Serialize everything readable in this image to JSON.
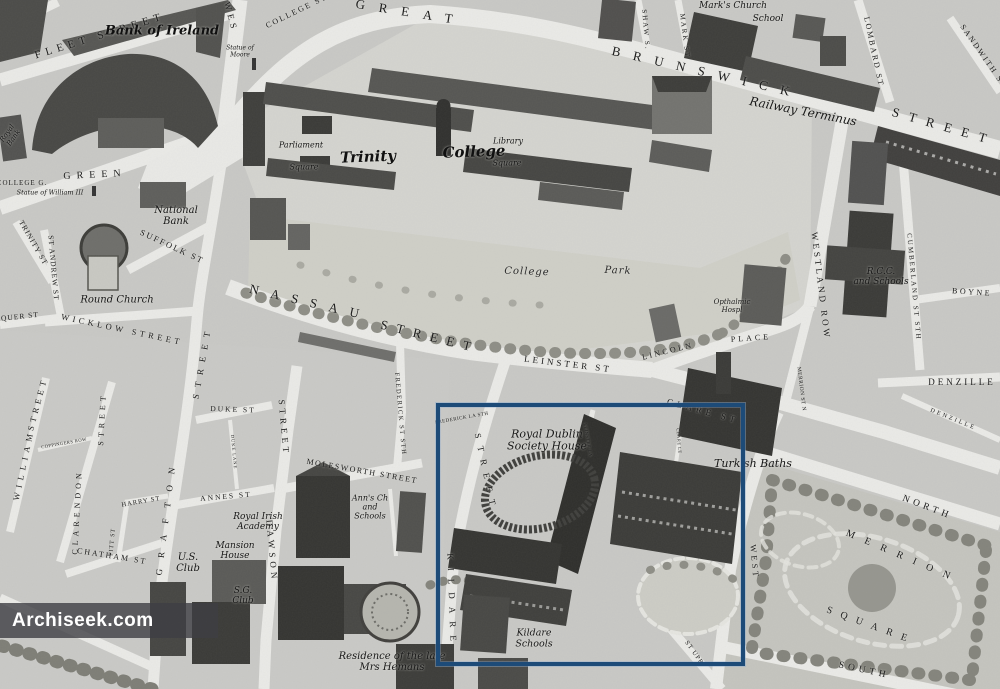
{
  "watermark": {
    "text": "Archiseek.com"
  },
  "highlight": {
    "color": "#1d4b78"
  },
  "map": {
    "labels": [
      {
        "n": "fleet-street",
        "t": "FLEET STREET",
        "x": 100,
        "y": 36,
        "r": -17,
        "fs": 11,
        "ls": 5,
        "st": "c"
      },
      {
        "n": "westmoreland-st",
        "t": "WES",
        "x": 231,
        "y": 17,
        "r": 75,
        "fs": 9,
        "ls": 4,
        "st": "c"
      },
      {
        "n": "college-st",
        "t": "COLLEGE ST",
        "x": 297,
        "y": 12,
        "r": -26,
        "fs": 8,
        "ls": 2,
        "st": "c"
      },
      {
        "n": "great",
        "t": "GREAT",
        "x": 411,
        "y": 13,
        "r": 9,
        "fs": 13,
        "ls": 14,
        "st": "c"
      },
      {
        "n": "brunswick",
        "t": "BRUNSWICK",
        "x": 707,
        "y": 73,
        "r": 13,
        "fs": 13,
        "ls": 13,
        "st": "c"
      },
      {
        "n": "gt-brunswick-street",
        "t": "STREET",
        "x": 944,
        "y": 127,
        "r": 16,
        "fs": 13,
        "ls": 10,
        "st": "c"
      },
      {
        "n": "railway-terminus",
        "t": "Railway Terminus",
        "x": 803,
        "y": 112,
        "r": 11,
        "fs": 12,
        "ls": 0,
        "st": "s"
      },
      {
        "n": "shaw-st",
        "t": "SHAW S.",
        "x": 645,
        "y": 30,
        "r": 85,
        "fs": 7,
        "ls": 2,
        "st": "c"
      },
      {
        "n": "mark-st",
        "t": "MARK ST",
        "x": 684,
        "y": 36,
        "r": 83,
        "fs": 7,
        "ls": 2,
        "st": "c"
      },
      {
        "n": "marks-church",
        "t": "Mark's Church",
        "x": 733,
        "y": 6,
        "r": 0,
        "fs": 9,
        "ls": 0,
        "st": "s"
      },
      {
        "n": "school",
        "t": "School",
        "x": 768,
        "y": 19,
        "r": 0,
        "fs": 9,
        "ls": 0,
        "st": "s"
      },
      {
        "n": "lombard-st",
        "t": "LOMBARD ST",
        "x": 873,
        "y": 52,
        "r": 78,
        "fs": 8,
        "ls": 2,
        "st": "c"
      },
      {
        "n": "sandwith-st",
        "t": "SANDWITH ST",
        "x": 983,
        "y": 57,
        "r": 55,
        "fs": 8,
        "ls": 2,
        "st": "c"
      },
      {
        "n": "statue-of-moore",
        "t": "Statue of\nMoore",
        "x": 240,
        "y": 52,
        "r": 0,
        "fs": 6,
        "ls": 0,
        "st": "s"
      },
      {
        "n": "bank-of-ireland",
        "t": "Bank of Ireland",
        "x": 162,
        "y": 32,
        "r": 0,
        "fs": 13,
        "ls": 0,
        "st": "b"
      },
      {
        "n": "royal-bank",
        "t": "Royal\nBank",
        "x": 11,
        "y": 136,
        "r": -55,
        "fs": 7,
        "ls": 0,
        "st": "s"
      },
      {
        "n": "college-green",
        "t": "COLLEGE G.",
        "x": 22,
        "y": 184,
        "r": 0,
        "fs": 7,
        "ls": 1,
        "st": "c"
      },
      {
        "n": "statue-of-william",
        "t": "Statue of William III",
        "x": 50,
        "y": 193,
        "r": 0,
        "fs": 6.5,
        "ls": 0,
        "st": "s"
      },
      {
        "n": "green",
        "t": "GREEN",
        "x": 95,
        "y": 175,
        "r": -3,
        "fs": 10,
        "ls": 6,
        "st": "c"
      },
      {
        "n": "national-bank",
        "t": "National\nBank",
        "x": 176,
        "y": 216,
        "r": 0,
        "fs": 10,
        "ls": 0,
        "st": "s"
      },
      {
        "n": "round-church",
        "t": "Round Church",
        "x": 117,
        "y": 300,
        "r": 0,
        "fs": 10,
        "ls": 0,
        "st": "s"
      },
      {
        "n": "suffolk-st",
        "t": "SUFFOLK ST",
        "x": 172,
        "y": 247,
        "r": 25,
        "fs": 8.5,
        "ls": 2,
        "st": "c"
      },
      {
        "n": "trinity-st",
        "t": "TRINITY ST",
        "x": 33,
        "y": 243,
        "r": 60,
        "fs": 7.5,
        "ls": 1,
        "st": "c"
      },
      {
        "n": "st-andrew-st",
        "t": "ST ANDREW ST",
        "x": 53,
        "y": 268,
        "r": 85,
        "fs": 7.5,
        "ls": 1,
        "st": "c"
      },
      {
        "n": "exchequer-st",
        "t": "QUER ST",
        "x": 20,
        "y": 317,
        "r": -6,
        "fs": 7.5,
        "ls": 1,
        "st": "c"
      },
      {
        "n": "wicklow-street",
        "t": "WICKLOW STREET",
        "x": 122,
        "y": 330,
        "r": 12,
        "fs": 8.5,
        "ls": 3.5,
        "st": "c"
      },
      {
        "n": "grafton",
        "t": "GRAFTON",
        "x": 166,
        "y": 516,
        "r": -83,
        "fs": 9,
        "ls": 11,
        "st": "c"
      },
      {
        "n": "grafton-street",
        "t": "STREET",
        "x": 202,
        "y": 362,
        "r": -80,
        "fs": 9,
        "ls": 7,
        "st": "c"
      },
      {
        "n": "william",
        "t": "WILLIAM",
        "x": 24,
        "y": 465,
        "r": -78,
        "fs": 8.5,
        "ls": 5,
        "st": "c"
      },
      {
        "n": "william-street",
        "t": "STREET",
        "x": 38,
        "y": 404,
        "r": -75,
        "fs": 8.5,
        "ls": 4,
        "st": "c"
      },
      {
        "n": "coppingers-row",
        "t": "COPPINGERS ROW",
        "x": 64,
        "y": 443,
        "r": -10,
        "fs": 4.5,
        "ls": 0.5,
        "st": "c"
      },
      {
        "n": "clarendon",
        "t": "CLARENDON",
        "x": 78,
        "y": 512,
        "r": -87,
        "fs": 8,
        "ls": 4,
        "st": "c"
      },
      {
        "n": "clarendon-street",
        "t": "STREET",
        "x": 103,
        "y": 419,
        "r": -87,
        "fs": 8,
        "ls": 4,
        "st": "c"
      },
      {
        "n": "pitt-st",
        "t": "PITT ST",
        "x": 113,
        "y": 542,
        "r": -85,
        "fs": 6,
        "ls": 1,
        "st": "c"
      },
      {
        "n": "harry-st",
        "t": "HARRY ST",
        "x": 141,
        "y": 502,
        "r": -10,
        "fs": 6.5,
        "ls": 1,
        "st": "c"
      },
      {
        "n": "chatham-st",
        "t": "CHATHAM ST",
        "x": 112,
        "y": 557,
        "r": 9,
        "fs": 8,
        "ls": 2,
        "st": "c"
      },
      {
        "n": "us-club",
        "t": "U.S.\nClub",
        "x": 188,
        "y": 563,
        "r": 0,
        "fs": 10,
        "ls": 0,
        "st": "s"
      },
      {
        "n": "sg-club",
        "t": "S.G.\nClub",
        "x": 243,
        "y": 596,
        "r": 0,
        "fs": 9,
        "ls": 0,
        "st": "s"
      },
      {
        "n": "duke-st",
        "t": "DUKE ST",
        "x": 233,
        "y": 410,
        "r": 2,
        "fs": 7.5,
        "ls": 2,
        "st": "c"
      },
      {
        "n": "duke-lane",
        "t": "DUKE LANE",
        "x": 234,
        "y": 452,
        "r": 85,
        "fs": 4.5,
        "ls": 1,
        "st": "c"
      },
      {
        "n": "annes-st",
        "t": "ANNES ST",
        "x": 226,
        "y": 497,
        "r": -5,
        "fs": 7.5,
        "ls": 2,
        "st": "c"
      },
      {
        "n": "dawson",
        "t": "DAWSON",
        "x": 272,
        "y": 551,
        "r": 85,
        "fs": 9,
        "ls": 4,
        "st": "c"
      },
      {
        "n": "dawson-street",
        "t": "STREET",
        "x": 284,
        "y": 428,
        "r": 85,
        "fs": 9,
        "ls": 4,
        "st": "c"
      },
      {
        "n": "molesworth-street",
        "t": "MOLESWORTH STREET",
        "x": 362,
        "y": 472,
        "r": 10,
        "fs": 8,
        "ls": 1.5,
        "st": "c"
      },
      {
        "n": "frederick-st-sth",
        "t": "FREDERICK ST STH",
        "x": 400,
        "y": 414,
        "r": 85,
        "fs": 6.5,
        "ls": 1.5,
        "st": "c"
      },
      {
        "n": "frederick-la-sth",
        "t": "FREDERICK LA STH",
        "x": 462,
        "y": 419,
        "r": -10,
        "fs": 5,
        "ls": 0.5,
        "st": "c"
      },
      {
        "n": "nassau",
        "t": "NASSAU",
        "x": 310,
        "y": 303,
        "r": 13,
        "fs": 13,
        "ls": 12,
        "st": "c"
      },
      {
        "n": "nassau-street",
        "t": "STREET",
        "x": 430,
        "y": 337,
        "r": 14,
        "fs": 13,
        "ls": 9,
        "st": "c"
      },
      {
        "n": "leinster-st",
        "t": "LEINSTER ST",
        "x": 568,
        "y": 364,
        "r": 7,
        "fs": 9,
        "ls": 3,
        "st": "c"
      },
      {
        "n": "kildare-street",
        "t": "STREET",
        "x": 486,
        "y": 473,
        "r": 78,
        "fs": 9,
        "ls": 8,
        "st": "c"
      },
      {
        "n": "kildare",
        "t": "KILDARE",
        "x": 452,
        "y": 601,
        "r": 88,
        "fs": 9,
        "ls": 8,
        "st": "c"
      },
      {
        "n": "royal-dublin-society-house",
        "t": "Royal Dublin\nSociety House",
        "x": 547,
        "y": 441,
        "r": 0,
        "fs": 11,
        "ls": 0,
        "st": "s"
      },
      {
        "n": "leinster-lane",
        "t": "LEINSTER LA",
        "x": 588,
        "y": 440,
        "r": 80,
        "fs": 4.5,
        "ls": 0.5,
        "st": "c"
      },
      {
        "n": "clare-st",
        "t": "CLARE ST",
        "x": 703,
        "y": 411,
        "r": 15,
        "fs": 9,
        "ls": 4,
        "st": "c"
      },
      {
        "n": "clare-lane",
        "t": "CLARE LE",
        "x": 679,
        "y": 441,
        "r": 85,
        "fs": 4.5,
        "ls": 0.5,
        "st": "c"
      },
      {
        "n": "turkish-baths",
        "t": "Turkish Baths",
        "x": 753,
        "y": 464,
        "r": 0,
        "fs": 11,
        "ls": 0,
        "st": "s"
      },
      {
        "n": "opthalmic-hospital",
        "t": "Opthalmic\nHospl",
        "x": 732,
        "y": 307,
        "r": 0,
        "fs": 7,
        "ls": 0,
        "st": "s"
      },
      {
        "n": "lincoln",
        "t": "LINCOLN",
        "x": 668,
        "y": 352,
        "r": -14,
        "fs": 8,
        "ls": 2.5,
        "st": "c"
      },
      {
        "n": "lincoln-place",
        "t": "PLACE",
        "x": 751,
        "y": 339,
        "r": -4,
        "fs": 8,
        "ls": 3,
        "st": "c"
      },
      {
        "n": "westland-row",
        "t": "WESTLAND ROW",
        "x": 821,
        "y": 286,
        "r": 83,
        "fs": 9,
        "ls": 3,
        "st": "c"
      },
      {
        "n": "rcc-and-schools",
        "t": "R.C.C.\nand Schools",
        "x": 881,
        "y": 277,
        "r": 0,
        "fs": 9,
        "ls": 0,
        "st": "s"
      },
      {
        "n": "cumberland-st-sth",
        "t": "CUMBERLAND ST STH",
        "x": 913,
        "y": 287,
        "r": 85,
        "fs": 7,
        "ls": 2,
        "st": "c"
      },
      {
        "n": "boyne",
        "t": "BOYNE",
        "x": 972,
        "y": 293,
        "r": 4,
        "fs": 8,
        "ls": 2.5,
        "st": "c"
      },
      {
        "n": "denzille",
        "t": "DENZILLE",
        "x": 962,
        "y": 382,
        "r": 0,
        "fs": 9,
        "ls": 3,
        "st": "c"
      },
      {
        "n": "denzille-lane",
        "t": "DENZILLE",
        "x": 953,
        "y": 420,
        "r": 22,
        "fs": 6,
        "ls": 2.5,
        "st": "c"
      },
      {
        "n": "merrion-st-n",
        "t": "MERRION ST N",
        "x": 801,
        "y": 389,
        "r": 83,
        "fs": 5.5,
        "ls": 0.5,
        "st": "c"
      },
      {
        "n": "merrion-st-upr",
        "t": "ST UPR",
        "x": 694,
        "y": 653,
        "r": 55,
        "fs": 6.5,
        "ls": 1,
        "st": "c"
      },
      {
        "n": "merrion-north",
        "t": "NORTH",
        "x": 927,
        "y": 508,
        "r": 21,
        "fs": 9.5,
        "ls": 4,
        "st": "c"
      },
      {
        "n": "merrion",
        "t": "MERRION",
        "x": 903,
        "y": 557,
        "r": 23,
        "fs": 10,
        "ls": 11,
        "st": "c"
      },
      {
        "n": "merrion-square",
        "t": "SQUARE",
        "x": 871,
        "y": 626,
        "r": 20,
        "fs": 10,
        "ls": 9,
        "st": "c"
      },
      {
        "n": "merrion-west",
        "t": "WEST",
        "x": 754,
        "y": 562,
        "r": 85,
        "fs": 8.5,
        "ls": 3,
        "st": "c"
      },
      {
        "n": "merrion-south",
        "t": "SOUTH",
        "x": 864,
        "y": 671,
        "r": 12,
        "fs": 9.5,
        "ls": 4,
        "st": "c"
      },
      {
        "n": "college-park-college",
        "t": "College",
        "x": 527,
        "y": 272,
        "r": 2,
        "fs": 10,
        "ls": 1,
        "st": "p"
      },
      {
        "n": "college-park-park",
        "t": "Park",
        "x": 618,
        "y": 271,
        "r": 2,
        "fs": 10,
        "ls": 1,
        "st": "p"
      },
      {
        "n": "parliament",
        "t": "Parliament",
        "x": 301,
        "y": 146,
        "r": 0,
        "fs": 8,
        "ls": 0,
        "st": "s"
      },
      {
        "n": "parliament-square",
        "t": "Square",
        "x": 304,
        "y": 168,
        "r": 0,
        "fs": 8,
        "ls": 0,
        "st": "s"
      },
      {
        "n": "trinity",
        "t": "Trinity",
        "x": 368,
        "y": 157,
        "r": -2,
        "fs": 15,
        "ls": 0,
        "st": "b"
      },
      {
        "n": "college",
        "t": "College",
        "x": 474,
        "y": 152,
        "r": -2,
        "fs": 15,
        "ls": 0,
        "st": "b"
      },
      {
        "n": "library",
        "t": "Library",
        "x": 508,
        "y": 142,
        "r": 0,
        "fs": 8,
        "ls": 0,
        "st": "s"
      },
      {
        "n": "library-square",
        "t": "Square",
        "x": 507,
        "y": 164,
        "r": 0,
        "fs": 8,
        "ls": 0,
        "st": "s"
      },
      {
        "n": "kildare-schools",
        "t": "Kildare\nSchools",
        "x": 534,
        "y": 639,
        "r": 0,
        "fs": 9.5,
        "ls": 0,
        "st": "s"
      },
      {
        "n": "residence-mrs-hemans",
        "t": "Residence of the late\nMrs Hemans",
        "x": 392,
        "y": 662,
        "r": 0,
        "fs": 10,
        "ls": 0,
        "st": "s"
      },
      {
        "n": "mansion-house",
        "t": "Mansion\nHouse",
        "x": 235,
        "y": 551,
        "r": 0,
        "fs": 9,
        "ls": 0,
        "st": "s"
      },
      {
        "n": "royal-irish-academy",
        "t": "Royal Irish\nAcademy",
        "x": 258,
        "y": 522,
        "r": 0,
        "fs": 9,
        "ls": 0,
        "st": "s"
      },
      {
        "n": "anns-church-schools",
        "t": "Ann's Ch\nand\nSchools",
        "x": 370,
        "y": 508,
        "r": 0,
        "fs": 8,
        "ls": 0,
        "st": "s"
      }
    ]
  }
}
